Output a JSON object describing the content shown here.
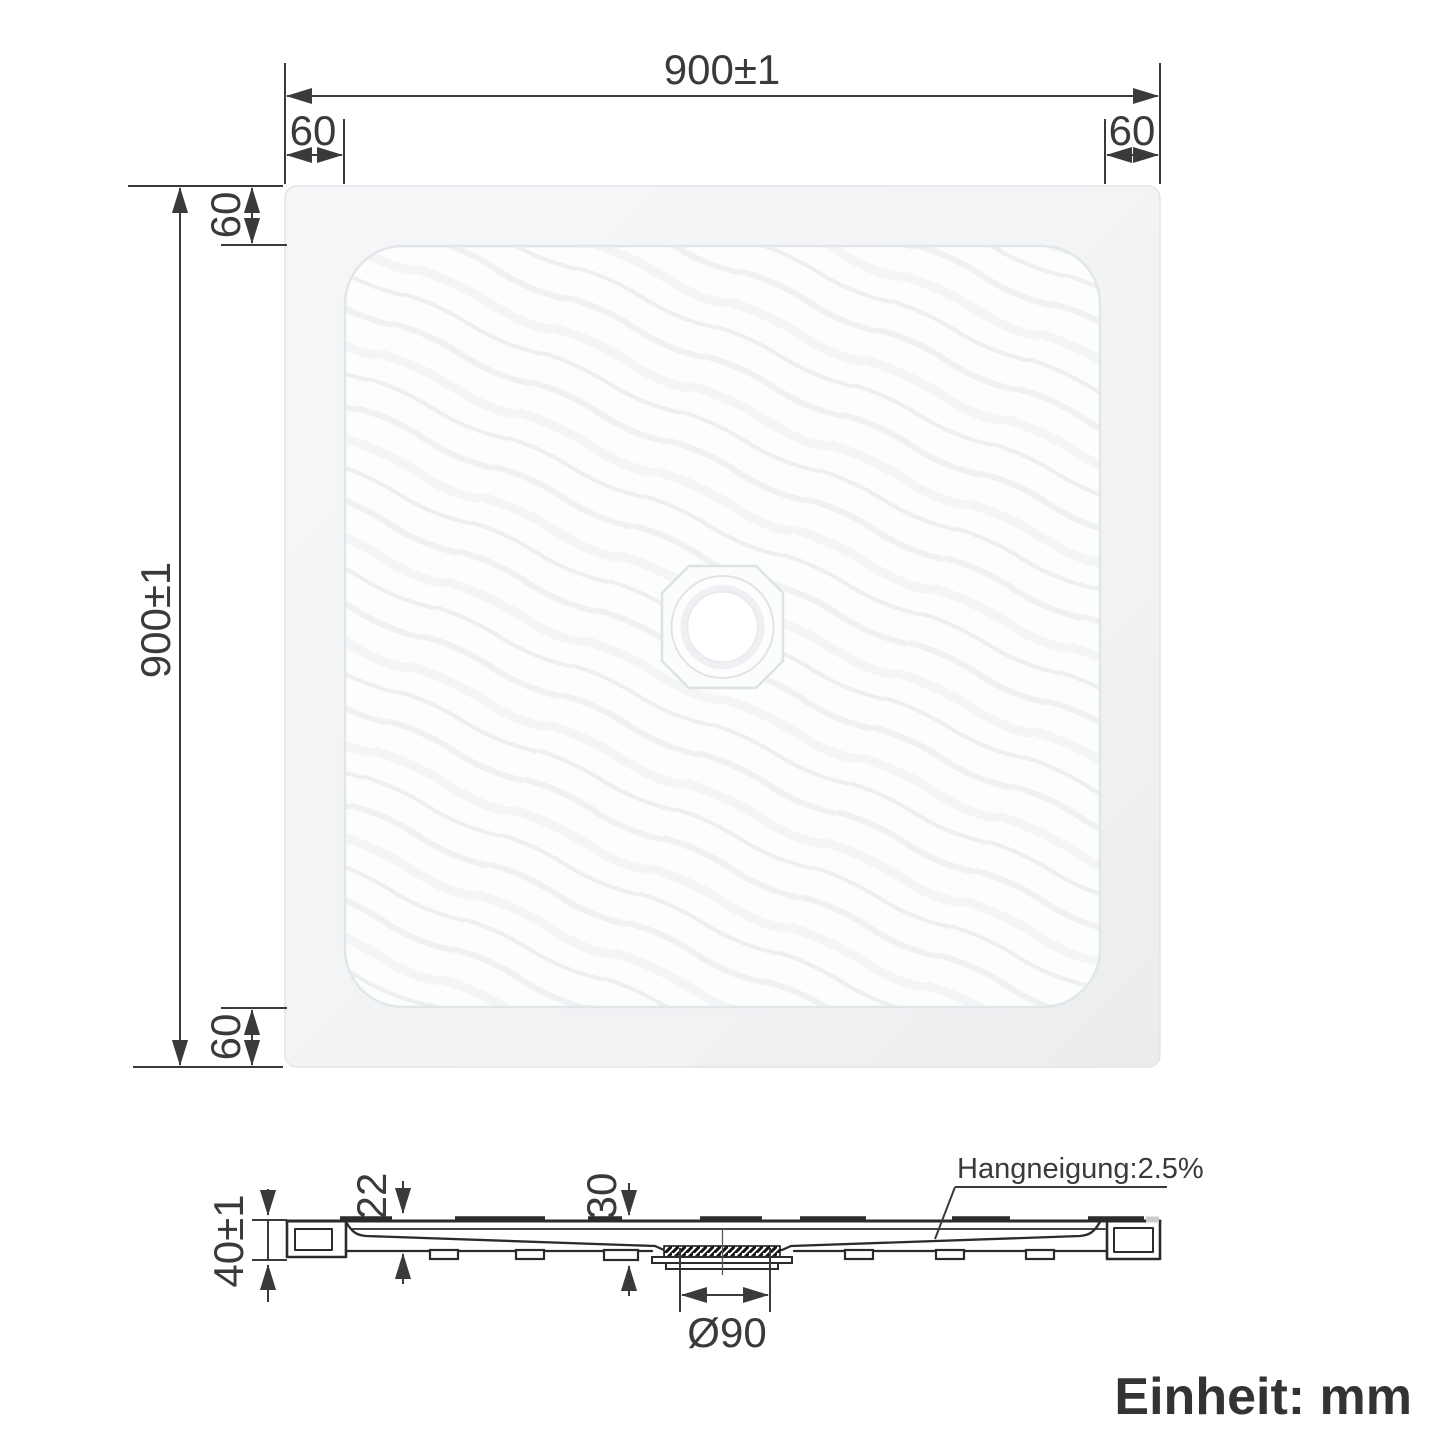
{
  "drawing": {
    "type": "shower-tray technical dimension drawing",
    "unit_note": "Einheit: mm",
    "top_view": {
      "width_dim": "900±1",
      "height_dim": "900±1",
      "margin_top_left": "60",
      "margin_top_right": "60",
      "margin_left_top": "60",
      "margin_left_bottom": "60"
    },
    "section_view": {
      "total_height_dim": "40±1",
      "rim_step_dim": "22",
      "drain_depth_dim": "30",
      "drain_diameter_dim": "Ø90",
      "slope_note": "Hangneigung:2.5%"
    },
    "colors": {
      "background": "#ffffff",
      "dimension_line": "#3a3a3a",
      "profile_line": "#2b2b2b",
      "tray_fill_light": "#f6f7f8",
      "tray_fill_dark": "#eceef0",
      "basin_fill": "#fcfdfd",
      "drain_hole_fill": "#ffffff"
    }
  }
}
